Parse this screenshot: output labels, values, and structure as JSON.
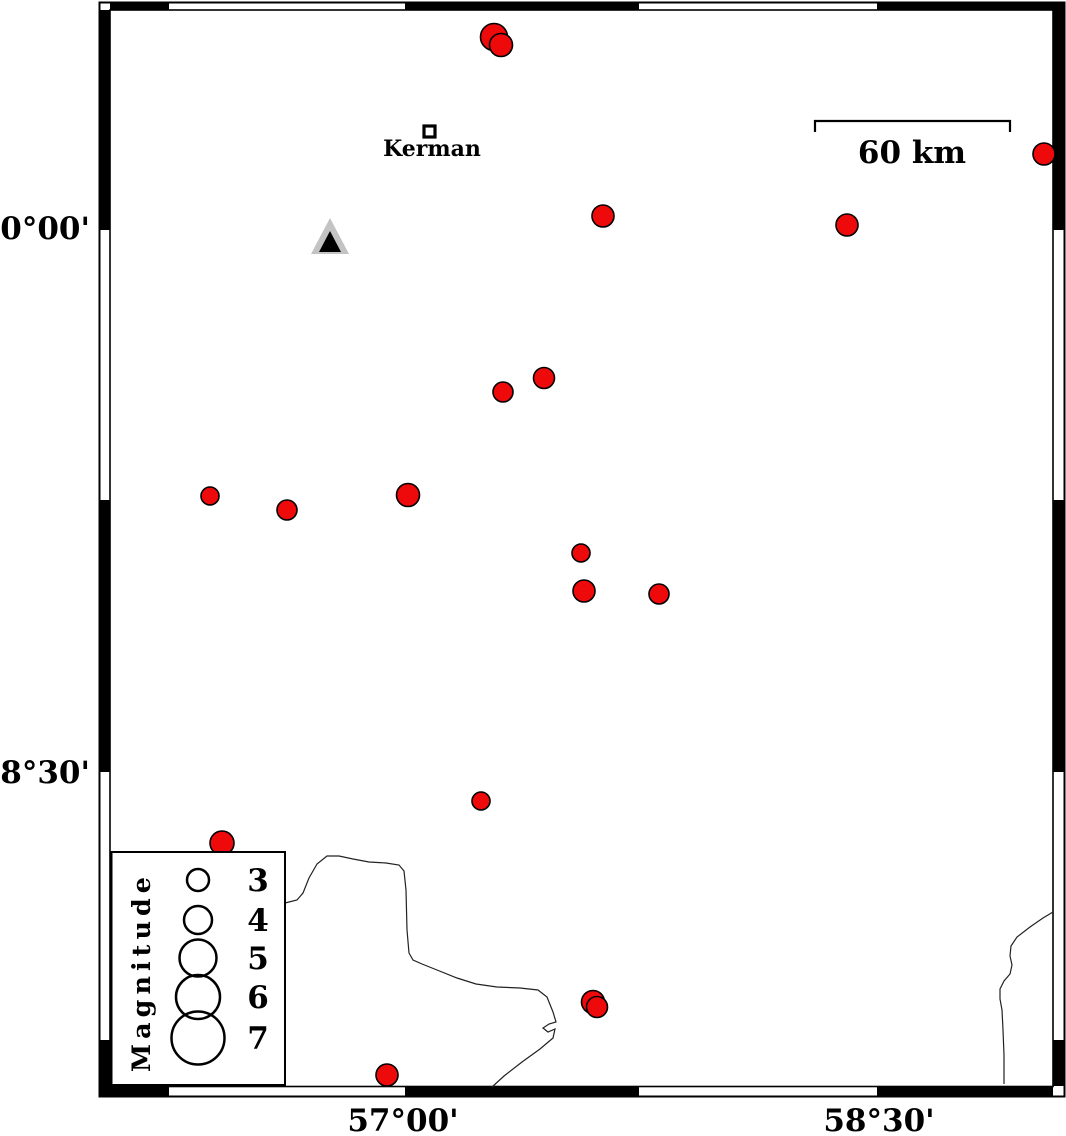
{
  "figure": {
    "axes": {
      "left_labels": [
        {
          "text": "30°00'",
          "y": 239
        },
        {
          "text": "28°30'",
          "y": 783
        }
      ],
      "bottom_labels": [
        {
          "text": "57°00'",
          "x": 403
        },
        {
          "text": "58°30'",
          "x": 879
        }
      ]
    },
    "city": {
      "name": "Kerman"
    },
    "scale_bar": {
      "label": "60 km"
    },
    "legend": {
      "title": "Magnitude"
    },
    "colors": {
      "earthquake_fill": "#ee0a0a",
      "marker_stroke": "#000000",
      "station_outer": "#c3c3c3",
      "station_inner": "#000000",
      "frame_black": "#000000",
      "contour": "#222222"
    }
  },
  "chart_data": {
    "type": "scatter",
    "title": "",
    "description": "Seismicity map around Kerman: red circles are earthquake epicenters sized by magnitude; triangle is a station; open-square marker is Kerman city; thin lines are geologic/drainage boundaries.",
    "legend_position": "bottom-left",
    "magnitude_legend": [
      {
        "label": "3",
        "cy": 880,
        "r": 11
      },
      {
        "label": "4",
        "cy": 920,
        "r": 14
      },
      {
        "label": "5",
        "cy": 958,
        "r": 18.5
      },
      {
        "label": "6",
        "cy": 997,
        "r": 22
      },
      {
        "label": "7",
        "cy": 1038,
        "r": 26.5
      }
    ],
    "earthquakes_px": [
      {
        "x": 494,
        "y": 37,
        "r": 13.5
      },
      {
        "x": 501,
        "y": 45,
        "r": 11.5
      },
      {
        "x": 1044,
        "y": 154,
        "r": 11
      },
      {
        "x": 603,
        "y": 216,
        "r": 11
      },
      {
        "x": 847,
        "y": 225,
        "r": 11
      },
      {
        "x": 544,
        "y": 378,
        "r": 10.5
      },
      {
        "x": 503,
        "y": 392,
        "r": 10
      },
      {
        "x": 210,
        "y": 496,
        "r": 9
      },
      {
        "x": 287,
        "y": 510,
        "r": 10
      },
      {
        "x": 408,
        "y": 495,
        "r": 11.5
      },
      {
        "x": 581,
        "y": 553,
        "r": 9
      },
      {
        "x": 584,
        "y": 591,
        "r": 11
      },
      {
        "x": 659,
        "y": 594,
        "r": 10
      },
      {
        "x": 481,
        "y": 801,
        "r": 9
      },
      {
        "x": 222,
        "y": 843,
        "r": 12
      },
      {
        "x": 593,
        "y": 1002,
        "r": 11.5
      },
      {
        "x": 597,
        "y": 1007,
        "r": 10.5
      },
      {
        "x": 387,
        "y": 1075,
        "r": 11
      }
    ],
    "contours_px": [
      {
        "points": [
          [
            285,
            903
          ],
          [
            297,
            900
          ],
          [
            303,
            893
          ],
          [
            309,
            878
          ],
          [
            317,
            864
          ],
          [
            327,
            856
          ],
          [
            339,
            856
          ],
          [
            353,
            859
          ],
          [
            369,
            862
          ],
          [
            386,
            863
          ],
          [
            399,
            865
          ],
          [
            404,
            871
          ],
          [
            406,
            890
          ],
          [
            407,
            930
          ],
          [
            409,
            953
          ],
          [
            413,
            960
          ],
          [
            422,
            964
          ],
          [
            437,
            970
          ],
          [
            457,
            978
          ],
          [
            476,
            984
          ],
          [
            497,
            987
          ],
          [
            520,
            988
          ],
          [
            538,
            990
          ],
          [
            547,
            997
          ],
          [
            553,
            1012
          ],
          [
            556,
            1022
          ],
          [
            549,
            1024
          ],
          [
            543,
            1028
          ],
          [
            548,
            1032
          ],
          [
            555,
            1029
          ],
          [
            553,
            1038
          ],
          [
            540,
            1049
          ],
          [
            522,
            1062
          ],
          [
            504,
            1076
          ],
          [
            492,
            1087
          ]
        ]
      },
      {
        "points": [
          [
            1053,
            912
          ],
          [
            1043,
            918
          ],
          [
            1030,
            927
          ],
          [
            1017,
            937
          ],
          [
            1011,
            946
          ],
          [
            1010,
            956
          ],
          [
            1012,
            965
          ],
          [
            1010,
            974
          ],
          [
            1004,
            981
          ],
          [
            1000,
            989
          ],
          [
            1000,
            999
          ],
          [
            1002,
            1010
          ],
          [
            1003,
            1030
          ],
          [
            1004,
            1055
          ],
          [
            1004,
            1084
          ]
        ]
      }
    ]
  }
}
